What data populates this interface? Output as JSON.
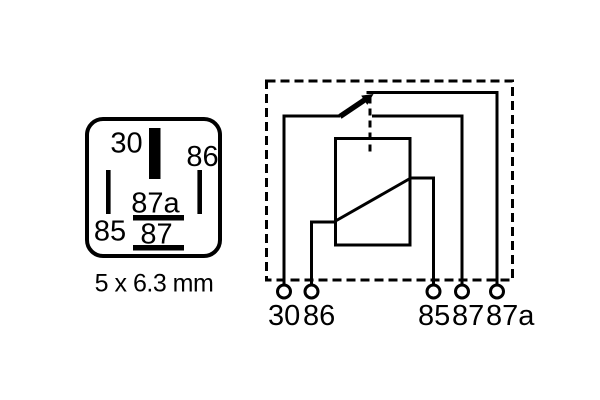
{
  "colors": {
    "ink": "#000000",
    "background": "#ffffff"
  },
  "pinout": {
    "caption": "5 x 6.3 mm",
    "pin_labels": {
      "p30": "30",
      "p86": "86",
      "p85": "85",
      "p87a": "87a",
      "p87": "87"
    }
  },
  "schematic": {
    "terminal_labels": {
      "t30": "30",
      "t86": "86",
      "t85": "85",
      "t87": "87",
      "t87a": "87a"
    }
  }
}
